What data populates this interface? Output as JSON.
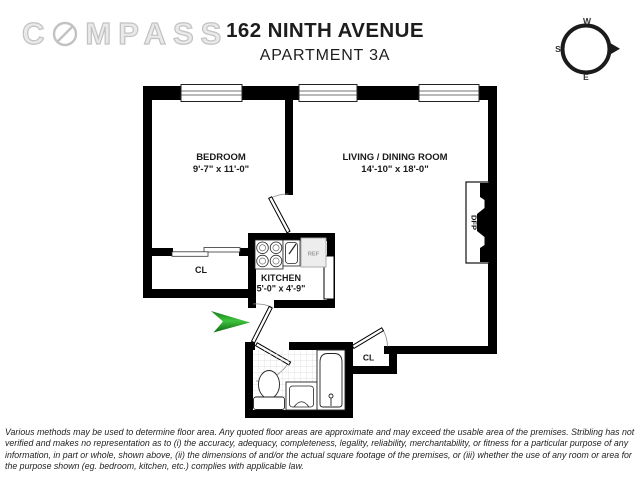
{
  "header": {
    "logo_pre": "C",
    "logo_post": "MPASS",
    "title": "162 NINTH AVENUE",
    "subtitle": "APARTMENT 3A"
  },
  "compass_rose": {
    "top": "W",
    "left": "S",
    "bottom": "E"
  },
  "floor_plan": {
    "rooms": [
      {
        "name": "BEDROOM",
        "dims": "9'-7\" x 11'-0\""
      },
      {
        "name": "LIVING / DINING ROOM",
        "dims": "14'-10\" x 18'-0\""
      },
      {
        "name": "KITCHEN",
        "dims": "5'-0\" x 4'-9\""
      }
    ],
    "closet_bedroom": "CL",
    "closet_hall": "CL",
    "fireplace": "DFP",
    "refrigerator": "REF"
  },
  "disclaimer": "Various methods may be used to determine floor area. Any quoted floor areas are approximate and may exceed the usable area of the premises. Stribling has not verified and makes no representation as to (i) the accuracy, adequacy, completeness, legality, reliability, merchantability, or fitness for a particular purpose of any information, in part or whole, shown above, (ii) the dimensions of and/or the actual square footage of the premises, or (iii) whether the use of any room or area for the purpose shown (eg. bedroom, kitchen, etc.) complies with applicable law.",
  "colors": {
    "wall": "#000000",
    "entry_arrow_green": "#2fae2f",
    "logo_gray": "#c2c2c2"
  }
}
